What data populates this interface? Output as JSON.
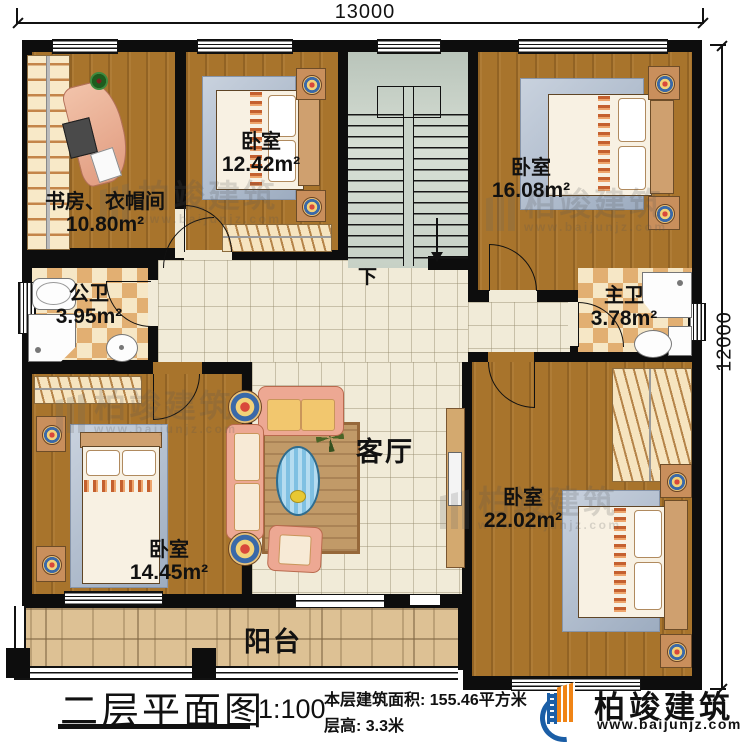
{
  "dimensions": {
    "top": "13000",
    "right": "12000"
  },
  "rooms": {
    "study": {
      "name": "书房、衣帽间",
      "area": "10.80m²"
    },
    "bedroom_top_middle": {
      "name": "卧室",
      "area": "12.42m²"
    },
    "bedroom_top_right": {
      "name": "卧室",
      "area": "16.08m²"
    },
    "bathroom_public": {
      "name": "公卫",
      "area": "3.95m²"
    },
    "bathroom_master": {
      "name": "主卫",
      "area": "3.78m²"
    },
    "living_room": {
      "name": "客厅"
    },
    "bedroom_bottom_left": {
      "name": "卧室",
      "area": "14.45m²"
    },
    "bedroom_bottom_right": {
      "name": "卧室",
      "area": "22.02m²"
    },
    "balcony": {
      "name": "阳台"
    },
    "staircase": {
      "direction_label": "下"
    }
  },
  "footer": {
    "title": "二层平面图",
    "scale": "1:100",
    "floor_area": "本层建筑面积: 155.46平方米",
    "floor_height": "层高: 3.3米"
  },
  "brand": {
    "name": "柏竣建筑",
    "website": "www.baijunjz.com"
  },
  "watermark": {
    "name": "柏竣建筑",
    "website": "www.baijunjz.com"
  },
  "colors": {
    "wall": "#0d0d0d",
    "wood_floor": "#a8742c",
    "tile_floor": "#f1ebd8",
    "stair_floor": "#ccd6cc",
    "bath_floor": "#f3e2c0",
    "balcony_floor": "#ddc194",
    "brand_blue": "#1b5ea6",
    "brand_orange": "#f08416"
  }
}
